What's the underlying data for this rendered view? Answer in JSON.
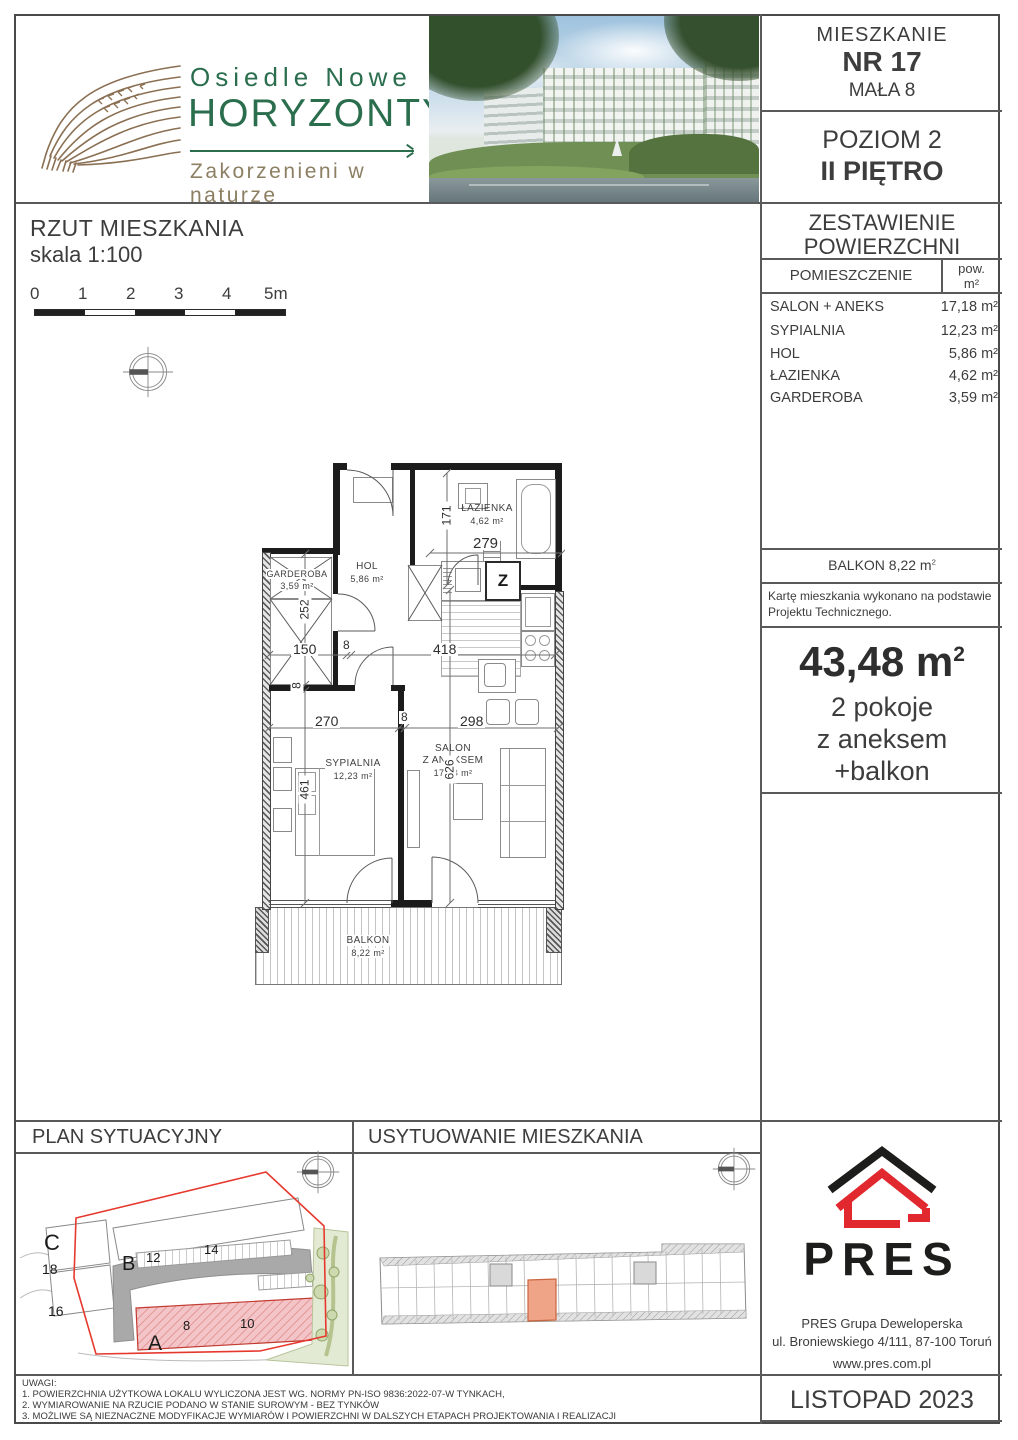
{
  "header": {
    "logo": {
      "line1": "Osiedle Nowe",
      "line2": "HORYZONTY",
      "tagline": "Zakorzenieni w naturze"
    },
    "apartment": {
      "label": "MIESZKANIE",
      "number": "NR 17",
      "street": "MAŁA 8"
    },
    "level": {
      "line1": "POZIOM 2",
      "line2": "II PIĘTRO"
    }
  },
  "area_table": {
    "title_line1": "ZESTAWIENIE",
    "title_line2": "POWIERZCHNI",
    "col_room": "POMIESZCZENIE",
    "col_area_line1": "pow.",
    "col_area_line2": "m²",
    "rows": [
      {
        "name": "SALON + ANEKS",
        "area": "17,18 m²"
      },
      {
        "name": "SYPIALNIA",
        "area": "12,23 m²"
      },
      {
        "name": "HOL",
        "area": "5,86 m²"
      },
      {
        "name": "ŁAZIENKA",
        "area": "4,62 m²"
      },
      {
        "name": "GARDEROBA",
        "area": "3,59 m²"
      }
    ],
    "balcony": {
      "text": "BALKON 8,22 m",
      "sup": "2"
    },
    "note": "Kartę mieszkania wykonano na podstawie Projektu Technicznego.",
    "summary": {
      "total": "43,48 m",
      "total_sup": "2",
      "line1": "2 pokoje",
      "line2": "z aneksem",
      "line3": "+balkon"
    }
  },
  "plan": {
    "title": "RZUT MIESZKANIA",
    "scale": "skala 1:100",
    "scale_bar": {
      "ticks": [
        "0",
        "1",
        "2",
        "3",
        "4",
        "5m"
      ]
    },
    "rooms": {
      "lazienka": {
        "name": "ŁAZIENKA",
        "area": "4,62 m²"
      },
      "garderoba": {
        "name": "GARDEROBA",
        "area": "3,59 m²"
      },
      "hol": {
        "name": "HOL",
        "area": "5,86 m²"
      },
      "sypialnia": {
        "name": "SYPIALNIA",
        "area": "12,23 m²"
      },
      "salon_line1": "SALON",
      "salon_line2": "Z ANEKSEM",
      "salon_area": "17,18 m²",
      "balkon": {
        "name": "BALKON",
        "area": "8,22 m²"
      }
    },
    "shaft_label": "Z",
    "dims": {
      "d171": "171",
      "d279": "279",
      "d252": "252",
      "d150": "150",
      "d8a": "8",
      "d418": "418",
      "d270": "270",
      "d8b": "8",
      "d298": "298",
      "d461": "461",
      "d626": "626",
      "d8c": "8"
    }
  },
  "bottom": {
    "site_plan_header": "PLAN SYTUACYJNY",
    "location_header": "USYTUOWANIE MIESZKANIA",
    "site_labels": {
      "A": "A",
      "B": "B",
      "C": "C",
      "n8": "8",
      "n10": "10",
      "n12": "12",
      "n14": "14",
      "n16": "16",
      "n18": "18"
    },
    "pres": {
      "wordmark": "PRES",
      "company": "PRES Grupa Deweloperska",
      "address": "ul. Broniewskiego 4/111, 87-100 Toruń",
      "website": "www.pres.com.pl",
      "date": "LISTOPAD 2023"
    },
    "notes": {
      "header": "UWAGI:",
      "item1": "1. POWIERZCHNIA UŻYTKOWA LOKALU WYLICZONA JEST WG. NORMY PN-ISO 9836:2022-07-W TYNKACH,",
      "item2": "2. WYMIAROWANIE NA RZUCIE PODANO W STANIE SUROWYM - BEZ TYNKÓW",
      "item3": "3. MOŻLIWE SĄ NIEZNACZNE MODYFIKACJE WYMIARÓW I POWIERZCHNI W DALSZYCH ETAPACH PROJEKTOWANIA I REALIZACJI"
    }
  }
}
